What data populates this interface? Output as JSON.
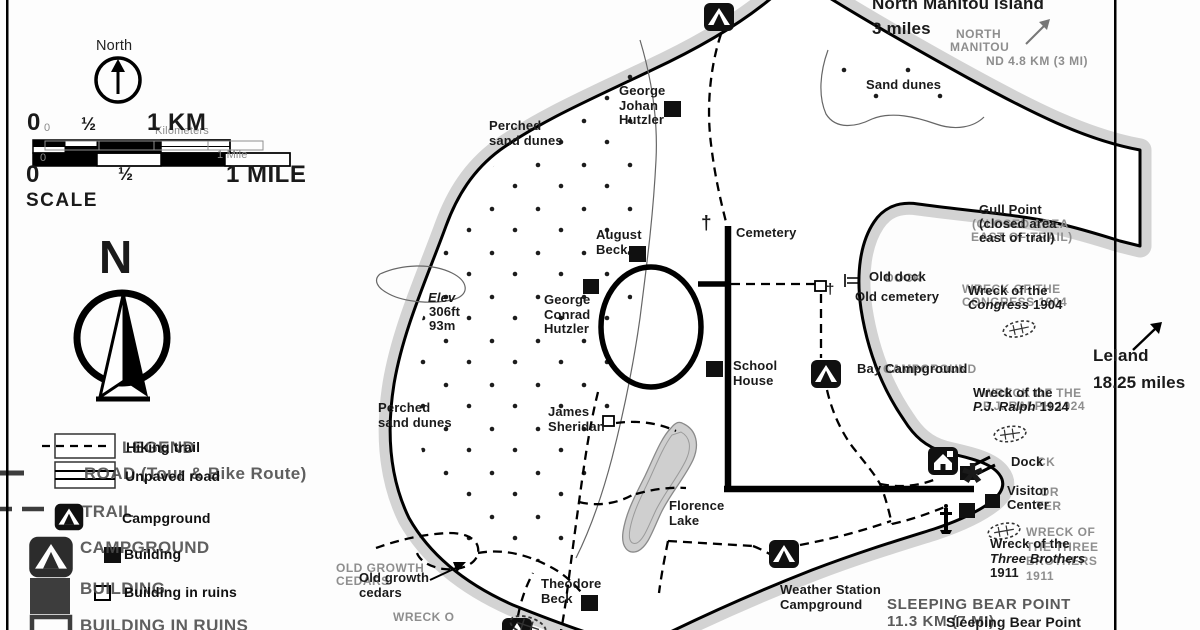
{
  "scalebar": {
    "km_0": "0",
    "km_half": "½",
    "km_1": "1 KM",
    "mi_0": "0",
    "mi_half": "½",
    "mi_1": "1 MILE",
    "label": "SCALE",
    "ghost_0_top": "0",
    "ghost_kilometers": "Kilometers",
    "ghost_0_bottom": "0",
    "ghost_1_mile": "1 Mile"
  },
  "compass": {
    "north_label": "North",
    "letter": "N"
  },
  "legend": {
    "ghost": {
      "title": "LEGEND",
      "road": "ROAD (Tour & Bike Route)",
      "trail": "TRAIL",
      "campground": "CAMPGROUND",
      "building": "BUILDING",
      "building_in_ruins": "BUILDING IN RUINS"
    },
    "items": {
      "hiking_trail": "Hiking trail",
      "unpaved_road": "Unpaved road",
      "campground": "Campground",
      "building": "Building",
      "building_in_ruins": "Building in ruins"
    }
  },
  "map": {
    "labels": {
      "north_manitou": "North Manitou Island\n3 miles",
      "sand_dunes": "Sand dunes",
      "perched_top": "Perched\nsand dunes",
      "perched_bottom": "Perched\nsand dunes",
      "george_johan": "George\nJohan\nHutzler",
      "august_beck": "August\nBeck",
      "cemetery": "Cemetery",
      "elev_l1": "Elev",
      "elev_l2": "306ft",
      "elev_l3": "93m",
      "george_conrad": "George\nConrad\nHutzler",
      "school_house": "School\nHouse",
      "james_sheridan": "James\nSheridan",
      "florence_lake": "Florence\nLake",
      "theodore_beck": "Theodore\nBeck",
      "old_growth": "Old growth\ncedars",
      "weather_station": "Weather Station\nCampground",
      "gull_point": "Gull Point\n(closed area\neast of trail)",
      "old_dock": "Old dock",
      "old_cemetery": "Old cemetery",
      "bay_campground": "Bay Campground",
      "dock": "Dock",
      "visitor_center": "Visitor\nCenter",
      "leland": "Leland\n18.25 miles",
      "sleeping_caps": "SLEEPING BEAR POINT",
      "sleeping_dist": "11.3 KM (7 MI)",
      "sleeping_lower": "Sleeping Bear Point"
    },
    "ghosts": {
      "north": "NORTH",
      "manitou": "MANITOU",
      "nm_dist": "ND 4.8 KM (3 MI)",
      "gull_closed": "(CLOSED AREA",
      "gull_east": "EAST OF TRAIL)",
      "dock_old": "DOCK",
      "bay": "CAMPGROUND",
      "dock_ck": "CK",
      "visitor_or": "OR",
      "visitor_ter": "TER",
      "old_growth": "OLD GROWTH\nCEDARS"
    },
    "wrecks": {
      "congress": {
        "l1": "Wreck of the",
        "name": "Congress",
        "year": "1904",
        "ghost": "WRECK OF THE\nCONGRESS 1904"
      },
      "ralph": {
        "l1": "Wreck of the",
        "name": "P.J. Ralph",
        "year": "1924",
        "ghost": "WRECK OF THE\nP.J. RALPH 1924"
      },
      "three_brothers": {
        "l1": "Wreck of the",
        "name": "Three Brothers",
        "year": "1911",
        "ghost": "WRECK OF\nTHE THREE\nBROTHERS\n1911"
      },
      "bottom_ghost": "WRECK O"
    },
    "glyphs": {
      "cross": "†",
      "asterisk": "*"
    },
    "icons": [
      "campground-icon",
      "ranger-station-icon",
      "lighthouse-icon",
      "shipwreck-icon",
      "building-square",
      "ruin-square",
      "north-arrow-icon",
      "compass-rose-icon",
      "dock-icon"
    ],
    "colors": {
      "water_band": "#d3d3d3",
      "lake": "#cfcfcf",
      "ink": "#111111",
      "ghost": "#8e8e8e"
    }
  }
}
